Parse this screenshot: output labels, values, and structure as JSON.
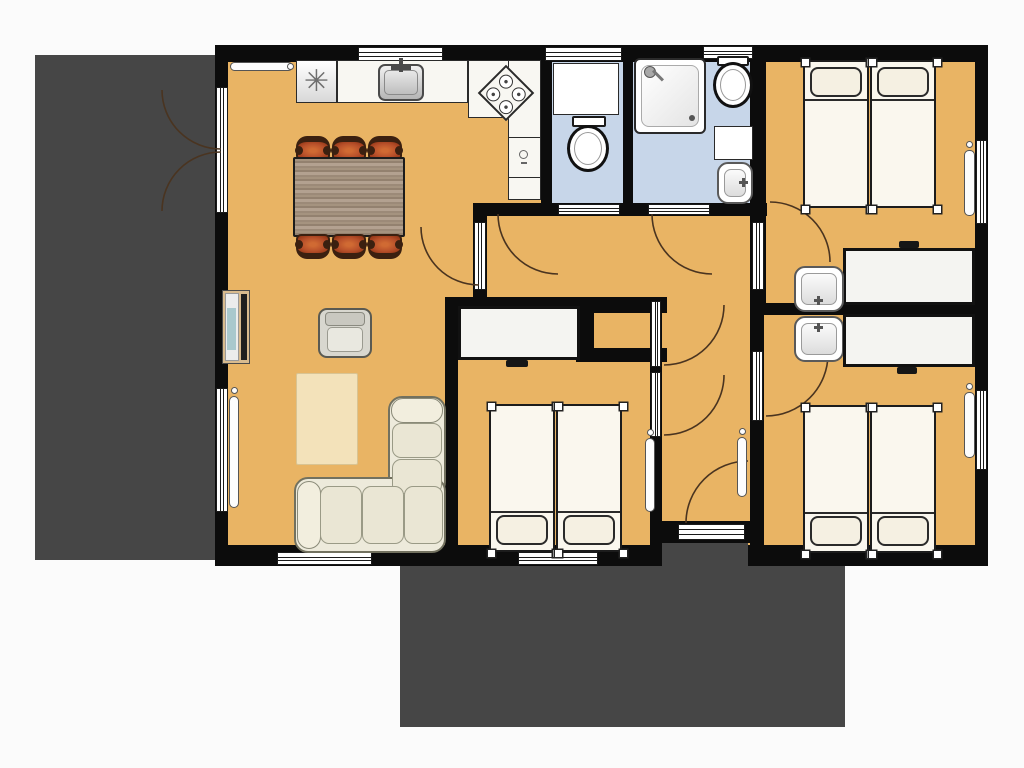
{
  "colors": {
    "background": "#fbfbfb",
    "wall": "#0c0c0c",
    "floor": "#e9b464",
    "bathroom_floor": "#c7d6e9",
    "terrace": "#464646",
    "furniture_white": "#f8f7f2",
    "rug": "#f3e2ba",
    "sofa": "#edeadb",
    "chair": "#b8502a",
    "chair_dark": "#3b2010",
    "tv_accent": "#a9c8cd",
    "stand_wood": "#d9bb8e",
    "door_arc": "#4a3420"
  },
  "symbols": {
    "freezer": "✳"
  },
  "rooms": [
    {
      "name": "living-dining-kitchen",
      "floor": "orange",
      "items": [
        "fridge-freezer",
        "kitchen counter",
        "kitchen sink",
        "stove",
        "dishwasher",
        "dining table",
        "6 chairs",
        "tv sideboard",
        "armchair",
        "rug",
        "corner sofa",
        "2 radiators"
      ]
    },
    {
      "name": "wc",
      "floor": "blue",
      "items": [
        "appliance",
        "toilet"
      ]
    },
    {
      "name": "bathroom",
      "floor": "blue",
      "items": [
        "shower",
        "toilet",
        "washbasin"
      ]
    },
    {
      "name": "bedroom-top-right",
      "floor": "orange",
      "items": [
        "2 single beds",
        "wardrobe",
        "washbasin",
        "radiator"
      ]
    },
    {
      "name": "bedroom-bottom-right",
      "floor": "orange",
      "items": [
        "2 single beds",
        "wardrobe",
        "washbasin",
        "radiator"
      ]
    },
    {
      "name": "bedroom-bottom-middle",
      "floor": "orange",
      "items": [
        "2 single beds",
        "wardrobe",
        "radiator"
      ]
    },
    {
      "name": "hallway",
      "floor": "orange",
      "items": [
        "radiator",
        "storage closet"
      ]
    },
    {
      "name": "terrace-left",
      "floor": "dark"
    },
    {
      "name": "terrace-bottom",
      "floor": "dark"
    }
  ]
}
